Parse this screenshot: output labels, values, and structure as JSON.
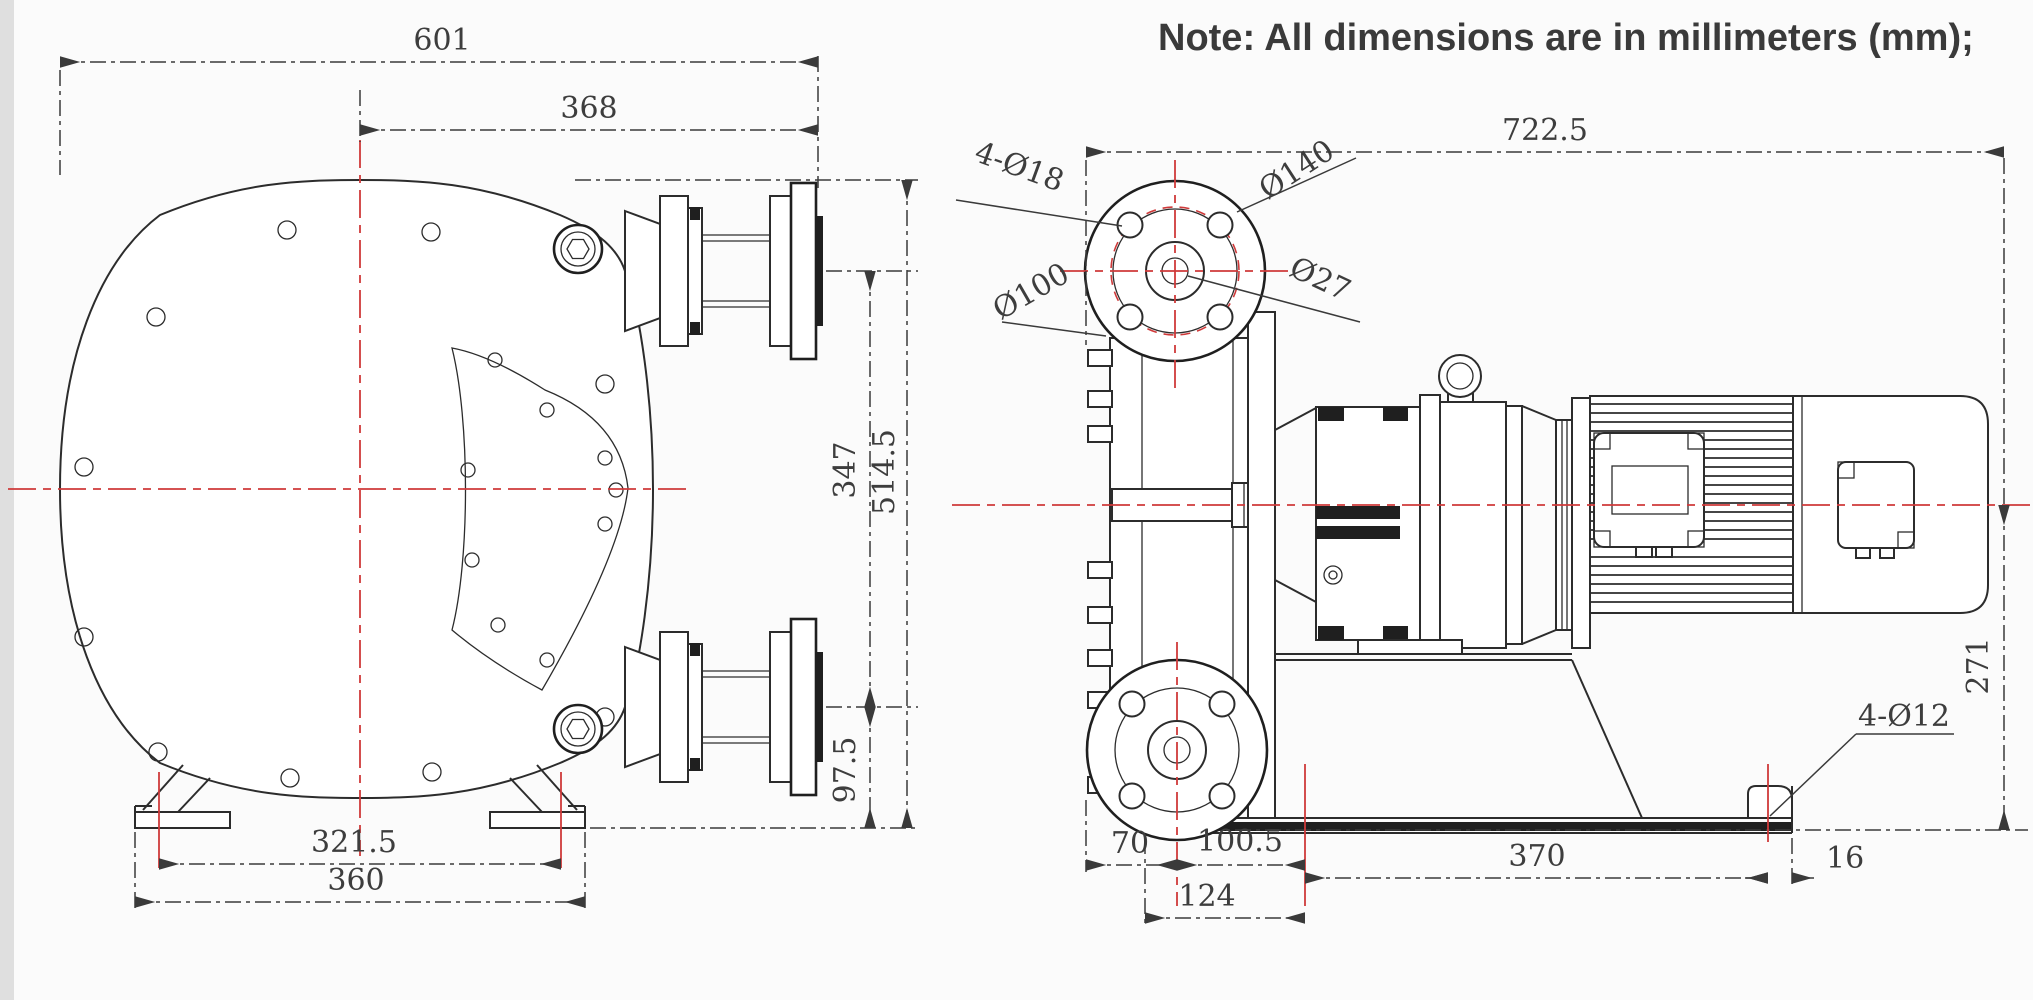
{
  "note": "Note: All dimensions are in millimeters (mm);",
  "colors": {
    "line": "#2c2c2c",
    "centerline_red": "#cf3a3a",
    "dim_text": "#3d3d3d",
    "background": "#fbfbfb"
  },
  "front_view": {
    "title": "pump-front-view",
    "dims": {
      "total_width": "601",
      "center_to_port_end": "368",
      "port_centers_spacing": "347",
      "total_height": "514.5",
      "port_to_base": "97.5",
      "foot_hole_spacing": "321.5",
      "base_width": "360"
    }
  },
  "side_view": {
    "title": "pump-side-view",
    "dims": {
      "total_length": "722.5",
      "shaft_center_height": "271",
      "flange_edge_to_center": "70",
      "flange_center_to_foot_hole": "100.5",
      "base_edge_to_foot_hole": "124",
      "foot_hole_span": "370",
      "foot_hole_to_base_end": "16"
    },
    "labels": {
      "flange_bolt_holes": "4-Ø18",
      "flange_outer_diameter": "Ø140",
      "flange_bolt_circle": "Ø100",
      "flange_bore": "Ø27",
      "base_holes": "4-Ø12"
    }
  }
}
